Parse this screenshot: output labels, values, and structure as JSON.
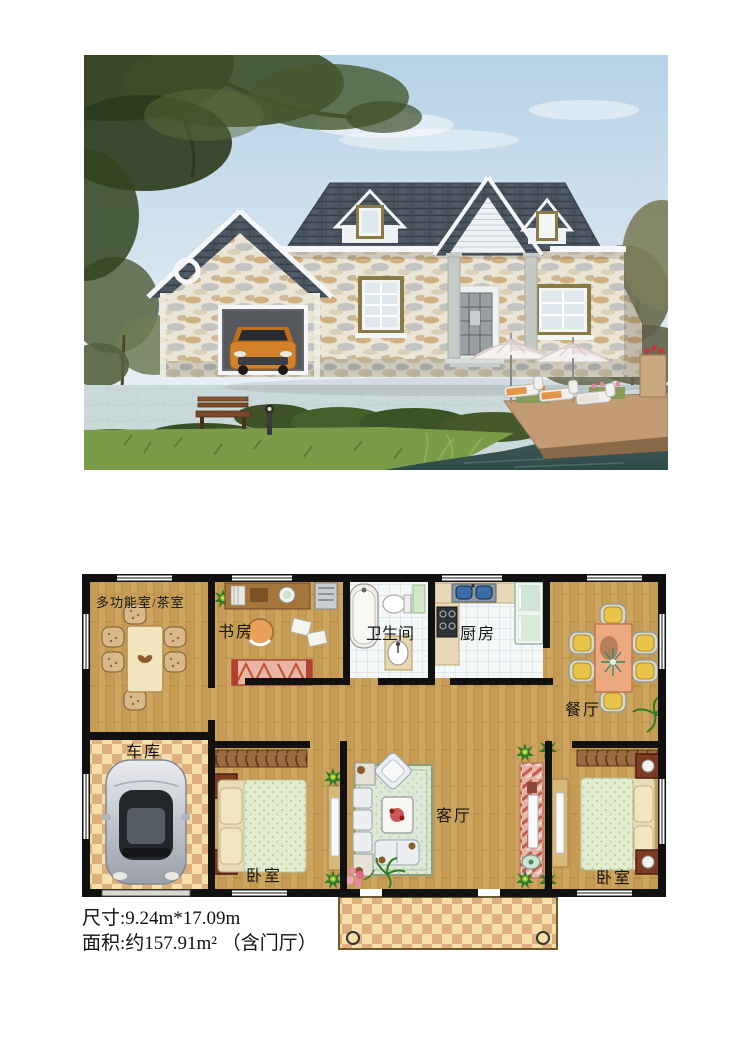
{
  "floor_plan": {
    "rooms": [
      {
        "key": "multi_tea",
        "label": "多功能室/茶室"
      },
      {
        "key": "study",
        "label": "书房"
      },
      {
        "key": "bathroom",
        "label": "卫生间"
      },
      {
        "key": "kitchen",
        "label": "厨房"
      },
      {
        "key": "dining",
        "label": "餐厅"
      },
      {
        "key": "garage",
        "label": "车库"
      },
      {
        "key": "bedroom_left",
        "label": "卧室"
      },
      {
        "key": "living",
        "label": "客厅"
      },
      {
        "key": "bedroom_right",
        "label": "卧室"
      }
    ]
  },
  "specs": {
    "line1": "尺寸:9.24m*17.09m",
    "line2": "面积:约157.91m² （含门厅）"
  },
  "colors": {
    "wood_floor": "#cda55f",
    "checker_light": "#f6dfa8",
    "checker_dark": "#ddae7e",
    "wall": "#111111",
    "tile_floor": "#f5f8f9",
    "roof_shingle": "#4a5560",
    "stone_wall": "#ebe5d6",
    "sky": "#b7d2e6",
    "lake_water": "#41605e",
    "grass": "#7a9c48",
    "car_orange": "#d4822a"
  }
}
